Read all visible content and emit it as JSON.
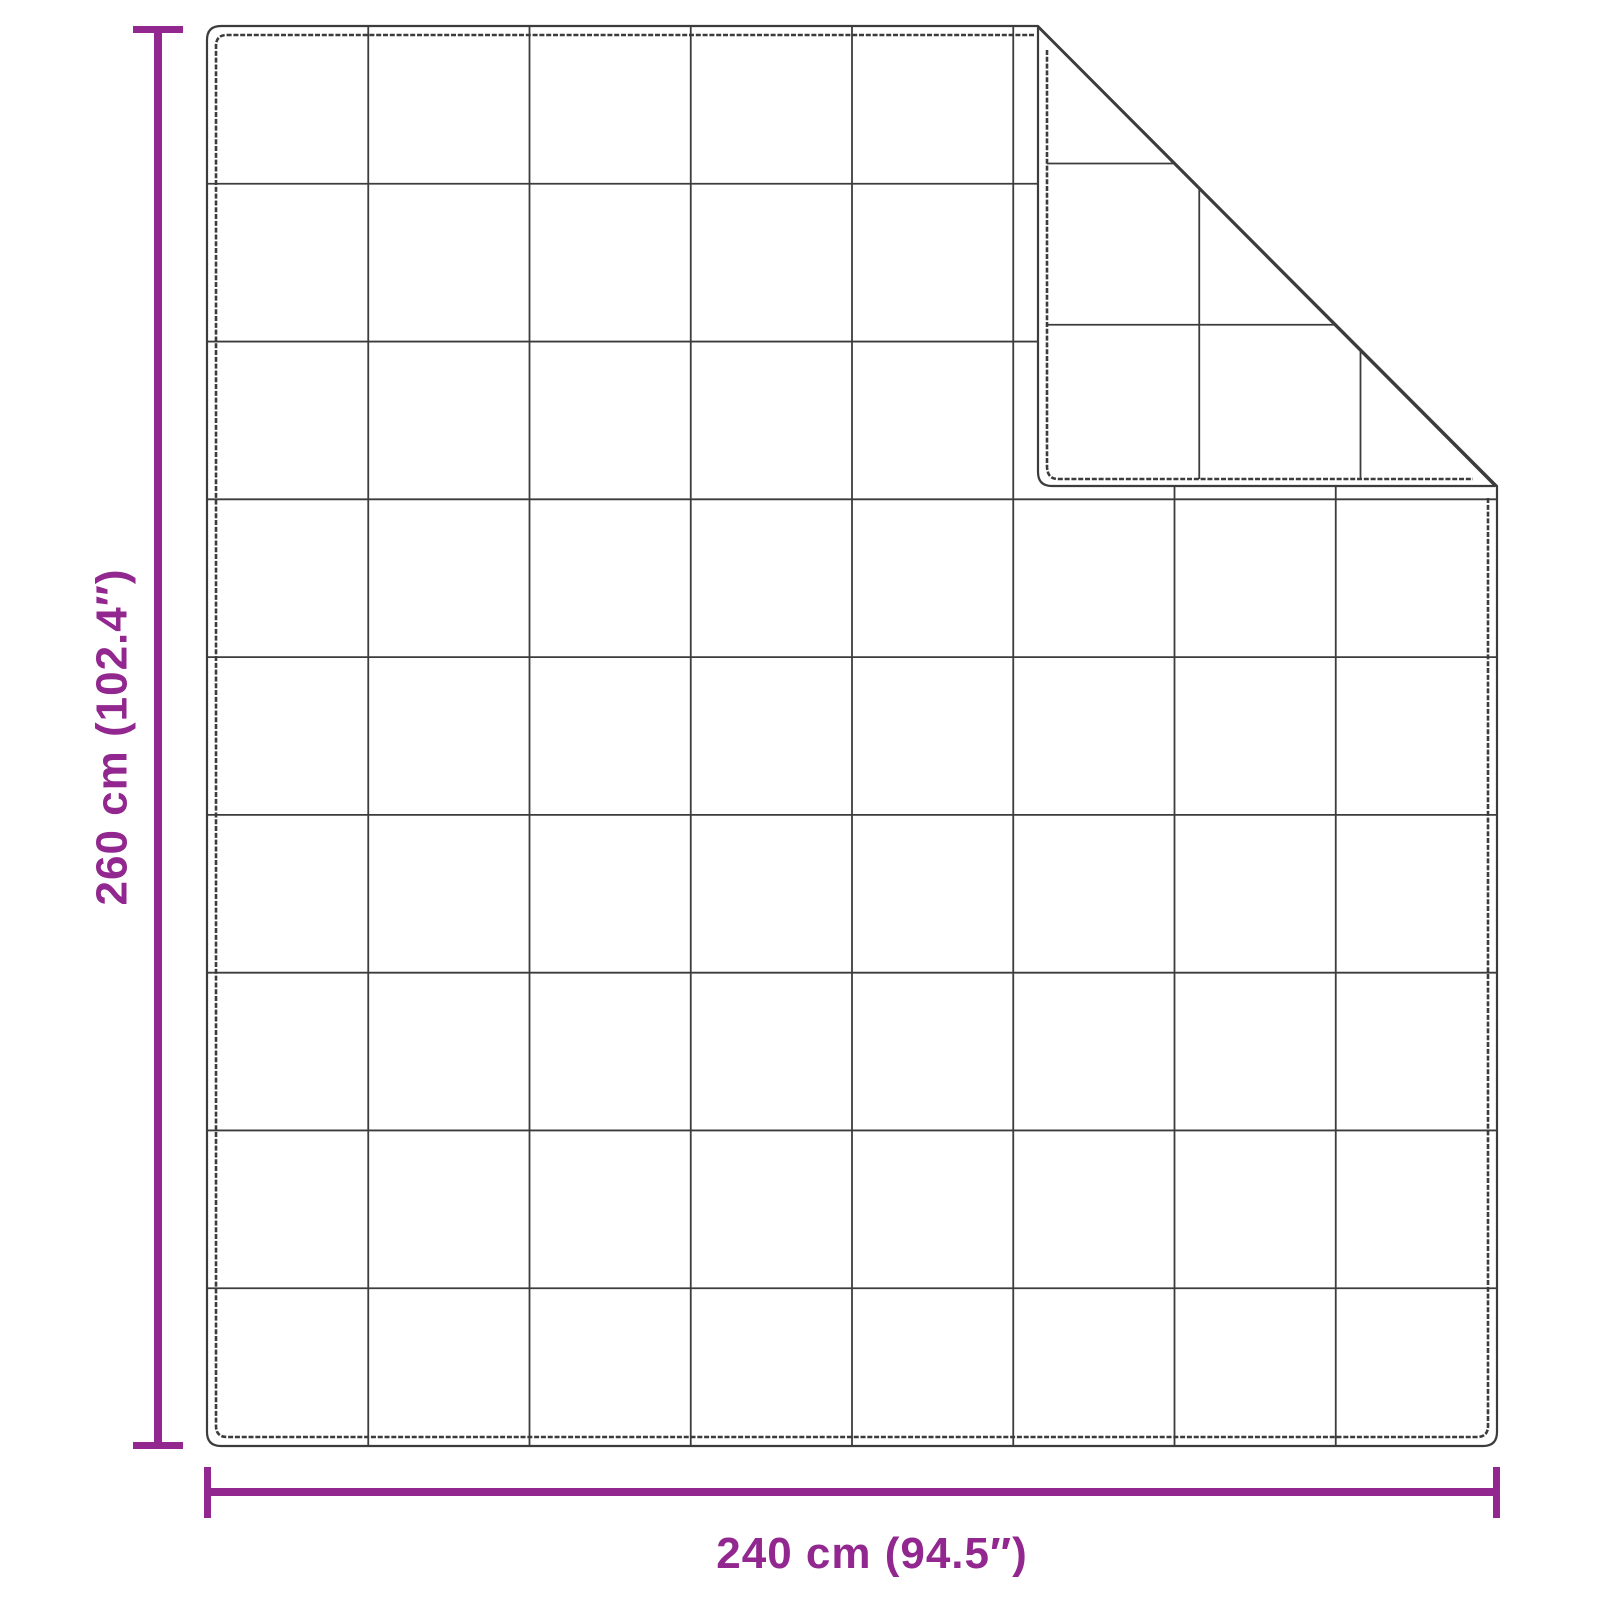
{
  "diagram": {
    "height_label": "260 cm (102.4″)",
    "width_label": "240 cm (94.5″)",
    "quilt_grid": {
      "columns": 8,
      "rows": 9
    },
    "folded_corner": "top-right",
    "colors": {
      "accent": "#92278F",
      "line": "#3C3C3C",
      "background": "#FFFFFF"
    }
  }
}
